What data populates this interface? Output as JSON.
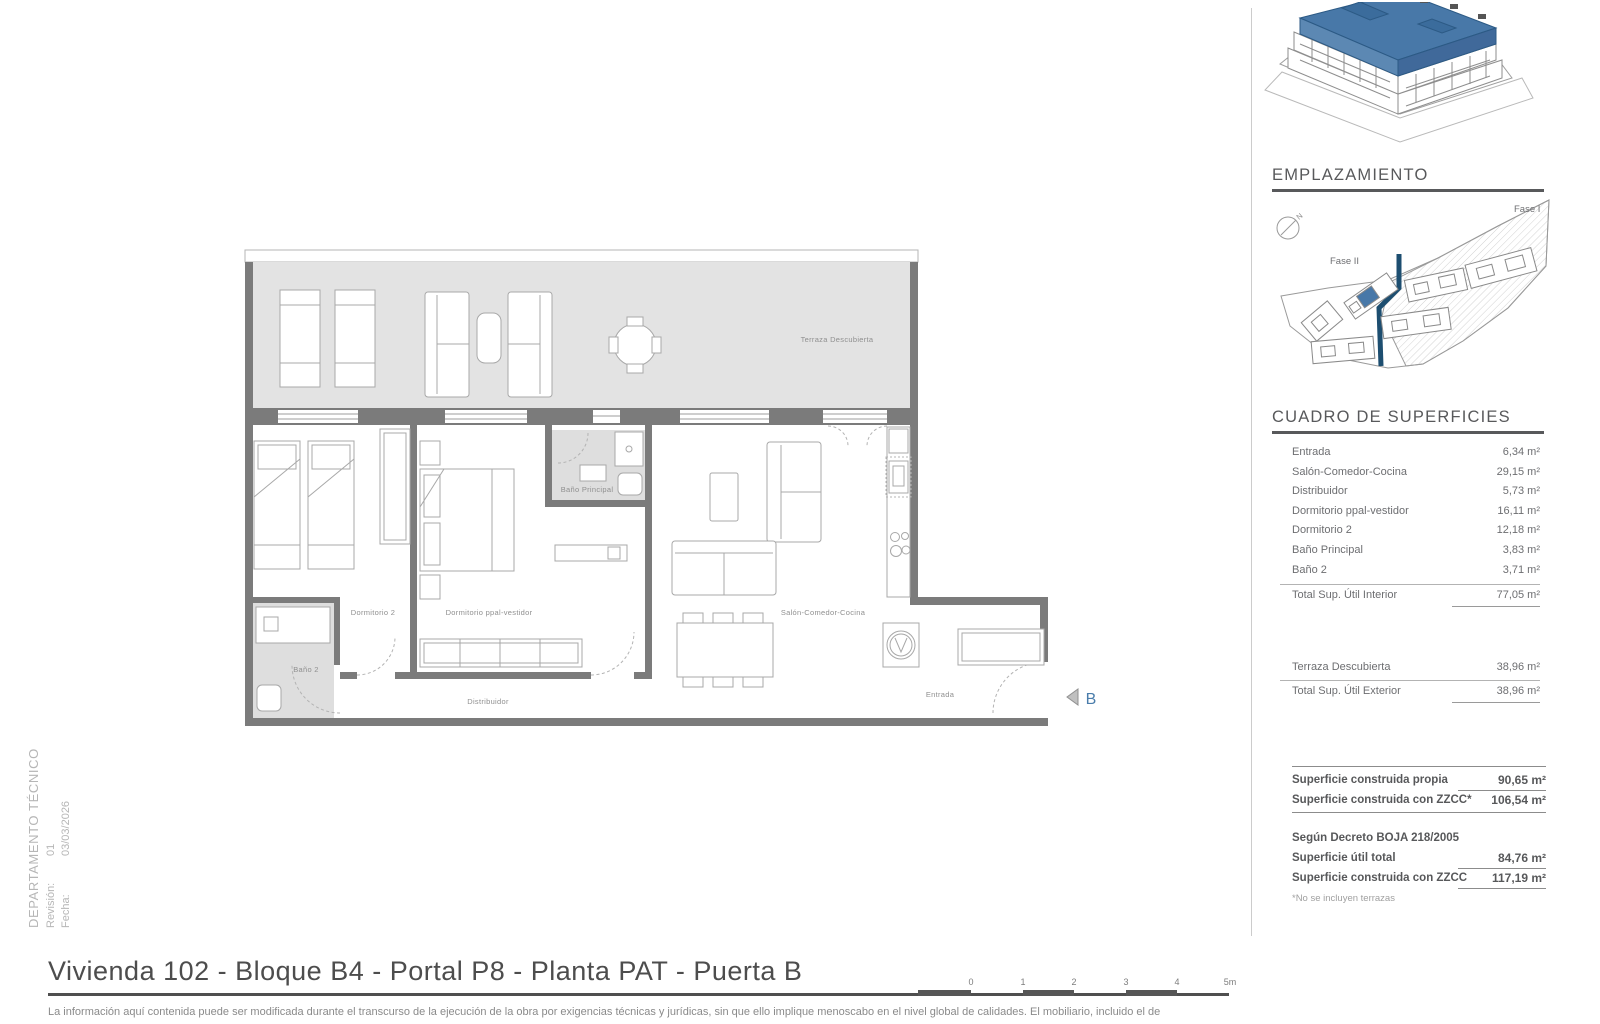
{
  "left_margin": {
    "department": "DEPARTAMENTO TÉCNICO",
    "revision_label": "Revisión:",
    "revision_value": "01",
    "date_label": "Fecha:",
    "date_value": "03/03/2026"
  },
  "plan": {
    "labels": {
      "terraza": "Terraza Descubierta",
      "dormitorio2": "Dormitorio 2",
      "dormitorio_ppal": "Dormitorio ppal-vestidor",
      "bano_principal": "Baño Principal",
      "bano2": "Baño 2",
      "distribuidor": "Distribuidor",
      "salon": "Salón-Comedor-Cocina",
      "entrada": "Entrada"
    },
    "door_marker": "B"
  },
  "sidebar": {
    "emplazamiento": {
      "title": "EMPLAZAMIENTO",
      "fase1": "Fase I",
      "fase2": "Fase II",
      "north": "N"
    },
    "superficies": {
      "title": "CUADRO DE SUPERFICIES",
      "rows": [
        {
          "label": "Entrada",
          "value": "6,34 m²"
        },
        {
          "label": "Salón-Comedor-Cocina",
          "value": "29,15 m²"
        },
        {
          "label": "Distribuidor",
          "value": "5,73 m²"
        },
        {
          "label": "Dormitorio ppal-vestidor",
          "value": "16,11 m²"
        },
        {
          "label": "Dormitorio 2",
          "value": "12,18 m²"
        },
        {
          "label": "Baño Principal",
          "value": "3,83 m²"
        },
        {
          "label": "Baño 2",
          "value": "3,71 m²"
        }
      ],
      "total_interior": {
        "label": "Total Sup. Útil Interior",
        "value": "77,05 m²"
      },
      "terraza_row": {
        "label": "Terraza Descubierta",
        "value": "38,96 m²"
      },
      "total_exterior": {
        "label": "Total Sup. Útil Exterior",
        "value": "38,96 m²"
      }
    },
    "summary": {
      "construida_propia": {
        "label": "Superficie construida propia",
        "value": "90,65 m²"
      },
      "construida_zzcc": {
        "label": "Superficie construida con ZZCC*",
        "value": "106,54 m²"
      },
      "decreto": "Según Decreto BOJA 218/2005",
      "util_total": {
        "label": "Superficie útil total",
        "value": "84,76 m²"
      },
      "construida_zzcc_decreto": {
        "label": "Superficie construida con ZZCC",
        "value": "117,19 m²"
      },
      "footnote": "*No se incluyen terrazas"
    }
  },
  "footer": {
    "title": "Vivienda 102 - Bloque B4 - Portal P8 - Planta PAT - Puerta B",
    "disclaimer": "La información aquí contenida puede  ser modificada durante el transcurso de la ejecución de la obra por exigencias técnicas y jurídicas,  sin  que  ello  implique  menoscabo  en el nivel global de calidades.  El  mobiliario, incluido el de",
    "scale": {
      "ticks": [
        "0",
        "1",
        "2",
        "3",
        "4"
      ],
      "end": "5m"
    }
  }
}
